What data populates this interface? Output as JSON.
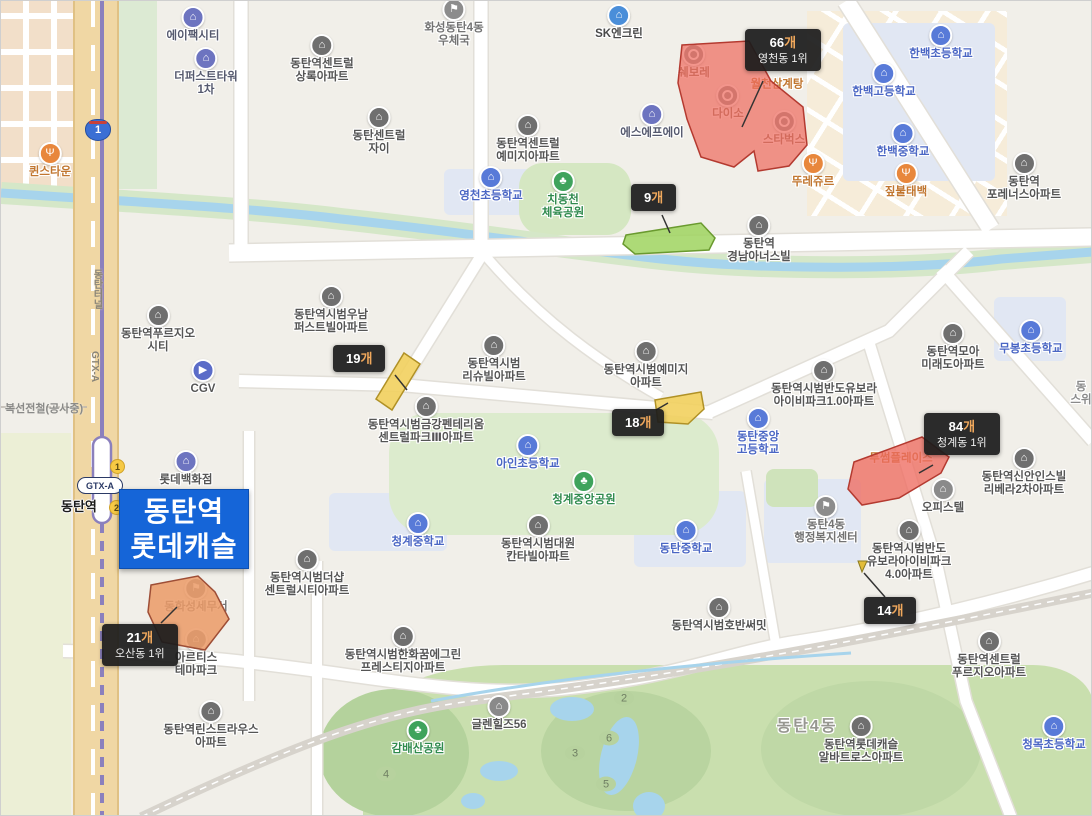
{
  "map": {
    "region_title": "동탄역 롯데캐슬",
    "overlay": {
      "lines": [
        "동탄역",
        "롯데캐슬"
      ],
      "bg_color": "#1565d8",
      "text_color": "#ffffff"
    },
    "station": {
      "name": "동탄역",
      "badge1": "1",
      "badge2": "2",
      "gtx_badge": "GTX-A",
      "tunnel_label": "동탄터널",
      "line_label": "GTX-A",
      "construction_label": "복선전철(공사중)"
    },
    "route_shield": "1",
    "colors": {
      "polygon_red": "#ee6c60",
      "polygon_green": "#9fd45f",
      "polygon_yellow": "#f2d05e",
      "polygon_orange": "#eb9a66",
      "overlay_blue": "#1565d8",
      "tooltip_bg": "#1c1c1c",
      "suffix_orange": "#f0a85c",
      "water": "#a7d4ec",
      "rail_purple": "#8b80bd"
    },
    "tooltips": [
      {
        "id": "yeongcheon",
        "count": "66",
        "suffix": "개",
        "rank": "영천동 1위",
        "x": 744,
        "y": 28,
        "line": [
          762,
          80,
          741,
          126
        ]
      },
      {
        "id": "green9",
        "count": "9",
        "suffix": "개",
        "rank": "",
        "x": 630,
        "y": 183,
        "line": [
          661,
          214,
          669,
          232
        ]
      },
      {
        "id": "yellow19",
        "count": "19",
        "suffix": "개",
        "rank": "",
        "x": 332,
        "y": 344,
        "line": [
          394,
          374,
          406,
          389
        ]
      },
      {
        "id": "yellow18",
        "count": "18",
        "suffix": "개",
        "rank": "",
        "x": 611,
        "y": 408,
        "line": [
          655,
          409,
          667,
          402
        ]
      },
      {
        "id": "cheonggye",
        "count": "84",
        "suffix": "개",
        "rank": "청계동 1위",
        "x": 923,
        "y": 412,
        "line": [
          932,
          464,
          918,
          472
        ]
      },
      {
        "id": "osan",
        "count": "21",
        "suffix": "개",
        "rank": "오산동 1위",
        "x": 101,
        "y": 623,
        "line": [
          160,
          622,
          176,
          606
        ]
      },
      {
        "id": "marker14",
        "count": "14",
        "suffix": "개",
        "rank": "",
        "x": 863,
        "y": 596,
        "line": [
          884,
          596,
          863,
          572
        ]
      }
    ],
    "polygons": [
      {
        "name": "yeongcheon-66",
        "color": "#ee6c60",
        "opacity": 0.72,
        "stroke": "#b43a30",
        "points": "681,44 748,40 770,80 802,106 806,144 788,165 757,170 753,150 733,166 700,156 686,118 677,82"
      },
      {
        "name": "green-9",
        "color": "#9fd45f",
        "opacity": 0.85,
        "stroke": "#6a9a2f",
        "points": "625,234 700,222 714,237 708,249 634,253 622,243"
      },
      {
        "name": "yellow-19",
        "color": "#f2d05e",
        "opacity": 0.9,
        "stroke": "#b09126",
        "points": "403,352 419,363 391,409 375,398"
      },
      {
        "name": "yellow-18",
        "color": "#f2d05e",
        "opacity": 0.9,
        "stroke": "#b09126",
        "points": "654,399 700,391 703,408 687,423 657,421"
      },
      {
        "name": "red-84",
        "color": "#ee6c60",
        "opacity": 0.78,
        "stroke": "#b43a30",
        "points": "853,461 921,436 948,456 940,472 898,497 861,504 847,488"
      },
      {
        "name": "orange-21",
        "color": "#eb9a66",
        "opacity": 0.85,
        "stroke": "#9e4e36",
        "points": "150,584 197,575 214,591 228,618 204,649 161,641 147,611"
      }
    ],
    "marker14": {
      "points": "857,560 866,560 861,571",
      "color": "#e2bd3a",
      "stroke": "#8a7a20"
    },
    "golf_holes": [
      {
        "n": "2",
        "x": 623,
        "y": 697
      },
      {
        "n": "6",
        "x": 608,
        "y": 737
      },
      {
        "n": "3",
        "x": 574,
        "y": 752
      },
      {
        "n": "5",
        "x": 605,
        "y": 783
      },
      {
        "n": "4",
        "x": 385,
        "y": 773
      }
    ],
    "pois": [
      {
        "t": "에이팩시티",
        "x": 192,
        "y": 14,
        "ic": "company"
      },
      {
        "t": "더퍼스트타워\n1차",
        "x": 205,
        "y": 55,
        "ic": "company"
      },
      {
        "t": "퀸스타운",
        "x": 49,
        "y": 150,
        "ic": "restaurant"
      },
      {
        "t": "화성동탄4동\n우체국",
        "x": 453,
        "y": 6,
        "ic": "government"
      },
      {
        "t": "동탄역센트럴\n상록아파트",
        "x": 321,
        "y": 42,
        "ic": "apartment"
      },
      {
        "t": "동탄센트럴\n자이",
        "x": 378,
        "y": 114,
        "ic": "apartment"
      },
      {
        "t": "동탄역센트럴\n예미지아파트",
        "x": 527,
        "y": 122,
        "ic": "apartment"
      },
      {
        "t": "영천초등학교",
        "x": 490,
        "y": 174,
        "ic": "school"
      },
      {
        "t": "치동천\n체육공원",
        "x": 562,
        "y": 178,
        "ic": "park"
      },
      {
        "t": "SK엔크린",
        "x": 618,
        "y": 12,
        "ic": "gas"
      },
      {
        "t": "에스에프에이",
        "x": 651,
        "y": 111,
        "ic": "company"
      },
      {
        "t": "쉐보레",
        "x": 693,
        "y": 51,
        "ic": "store",
        "under": true
      },
      {
        "t": "다이소",
        "x": 727,
        "y": 92,
        "ic": "store",
        "under": true
      },
      {
        "t": "스타벅스",
        "x": 783,
        "y": 118,
        "ic": "store",
        "under": true
      },
      {
        "t": "월천삼계탕",
        "x": 776,
        "y": 84,
        "ic": "none",
        "cls": "orange",
        "under": true
      },
      {
        "t": "뚜레쥬르",
        "x": 812,
        "y": 160,
        "ic": "restaurant"
      },
      {
        "t": "짚불태백",
        "x": 905,
        "y": 170,
        "ic": "restaurant"
      },
      {
        "t": "한백초등학교",
        "x": 940,
        "y": 32,
        "ic": "school"
      },
      {
        "t": "한백고등학교",
        "x": 883,
        "y": 70,
        "ic": "school"
      },
      {
        "t": "한백중학교",
        "x": 902,
        "y": 130,
        "ic": "school"
      },
      {
        "t": "동탄역\n포레너스아파트",
        "x": 1023,
        "y": 160,
        "ic": "apartment"
      },
      {
        "t": "아이비파크2.0",
        "x": 1013,
        "y": -7,
        "ic": "none",
        "cls": "partial"
      },
      {
        "t": "동탄역\n경남아너스빌",
        "x": 758,
        "y": 222,
        "ic": "apartment"
      },
      {
        "t": "동탄역푸르지오\n시티",
        "x": 157,
        "y": 312,
        "ic": "apartment"
      },
      {
        "t": "CGV",
        "x": 202,
        "y": 367,
        "ic": "cinema"
      },
      {
        "t": "롯데백화점",
        "x": 185,
        "y": 458,
        "ic": "dept"
      },
      {
        "t": "동탄역시범우남\n퍼스트빌아파트",
        "x": 330,
        "y": 293,
        "ic": "apartment"
      },
      {
        "t": "동탄역시범\n리슈빌아파트",
        "x": 493,
        "y": 342,
        "ic": "apartment"
      },
      {
        "t": "동탄역시범예미지\n아파트",
        "x": 645,
        "y": 348,
        "ic": "apartment"
      },
      {
        "t": "동탄역시범반도유보라\n아이비파크1.0아파트",
        "x": 823,
        "y": 367,
        "ic": "apartment"
      },
      {
        "t": "동탄역모아\n미래도아파트",
        "x": 952,
        "y": 330,
        "ic": "apartment"
      },
      {
        "t": "무봉초등학교",
        "x": 1030,
        "y": 327,
        "ic": "school"
      },
      {
        "t": "동\n스위",
        "x": 1080,
        "y": 393,
        "ic": "none",
        "cls": "partial"
      },
      {
        "t": "동탄역시범금강펜테리움\n센트럴파크Ⅲ아파트",
        "x": 425,
        "y": 403,
        "ic": "apartment"
      },
      {
        "t": "아인초등학교",
        "x": 527,
        "y": 442,
        "ic": "school"
      },
      {
        "t": "동탄중앙\n고등학교",
        "x": 757,
        "y": 415,
        "ic": "school"
      },
      {
        "t": "투썸플레이스",
        "x": 900,
        "y": 458,
        "ic": "none",
        "cls": "orange",
        "under": true
      },
      {
        "t": "동탄역신안인스빌\n리베라2차아파트",
        "x": 1023,
        "y": 455,
        "ic": "apartment"
      },
      {
        "t": "오피스텔",
        "x": 942,
        "y": 486,
        "ic": "building"
      },
      {
        "t": "청계중앙공원",
        "x": 583,
        "y": 478,
        "ic": "park"
      },
      {
        "t": "청계중학교",
        "x": 417,
        "y": 520,
        "ic": "school"
      },
      {
        "t": "동탄역시범더샵\n센트럴시티아파트",
        "x": 306,
        "y": 556,
        "ic": "apartment"
      },
      {
        "t": "동탄역시범대원\n칸타빌아파트",
        "x": 537,
        "y": 522,
        "ic": "apartment"
      },
      {
        "t": "동탄중학교",
        "x": 685,
        "y": 527,
        "ic": "school"
      },
      {
        "t": "동탄4동\n행정복지센터",
        "x": 825,
        "y": 503,
        "ic": "government"
      },
      {
        "t": "동탄역시범반도\n유보라아이비파크\n4.0아파트",
        "x": 908,
        "y": 527,
        "ic": "apartment"
      },
      {
        "t": "동화성세무서",
        "x": 195,
        "y": 585,
        "ic": "government",
        "under": true
      },
      {
        "t": "아르티스\n테마파크",
        "x": 195,
        "y": 636,
        "ic": "building"
      },
      {
        "t": "동탄역시범호반써밋",
        "x": 718,
        "y": 604,
        "ic": "apartment"
      },
      {
        "t": "동탄역린스트라우스\n아파트",
        "x": 210,
        "y": 708,
        "ic": "apartment"
      },
      {
        "t": "동탄역시범한화꿈에그린\n프레스티지아파트",
        "x": 402,
        "y": 633,
        "ic": "apartment"
      },
      {
        "t": "감배산공원",
        "x": 417,
        "y": 727,
        "ic": "park"
      },
      {
        "t": "글렌힐즈56",
        "x": 498,
        "y": 703,
        "ic": "building"
      },
      {
        "t": "동탄4동",
        "x": 806,
        "y": 726,
        "ic": "none",
        "cls": "district"
      },
      {
        "t": "동탄역센트럴\n푸르지오아파트",
        "x": 988,
        "y": 638,
        "ic": "apartment"
      },
      {
        "t": "동탄역롯데캐슬\n알바트로스아파트",
        "x": 860,
        "y": 723,
        "ic": "apartment"
      },
      {
        "t": "청목초등학교",
        "x": 1053,
        "y": 723,
        "ic": "school"
      }
    ]
  }
}
